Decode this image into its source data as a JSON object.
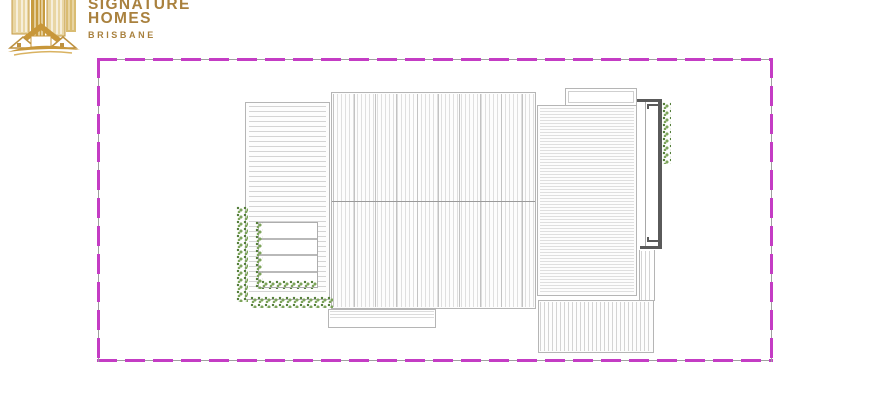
{
  "logo": {
    "line1": "SIGNATURE",
    "line2": "HOMES",
    "line3": "BRISBANE",
    "icon": "gold-city-skyline-with-house-and-swoosh"
  },
  "colors": {
    "boundary": "#c43cc4",
    "outline": "#b5b5b5",
    "roof_hatch": "#d4d4d4",
    "ridge": "#9a9a9a",
    "deck_wall": "#5a5a5a",
    "vegetation": "#7da45b",
    "logo_gold": "#a9813e"
  },
  "plan": {
    "type": "roof-plan",
    "boundary": "dashed-site-boundary",
    "sections": [
      "left-wing-roof",
      "main-roof-with-ridge",
      "right-wing-roof",
      "roof-bump-out",
      "deck-edge-wall",
      "lower-right-roof",
      "front-porch-roof",
      "garden-steps",
      "vegetation-strips"
    ]
  }
}
